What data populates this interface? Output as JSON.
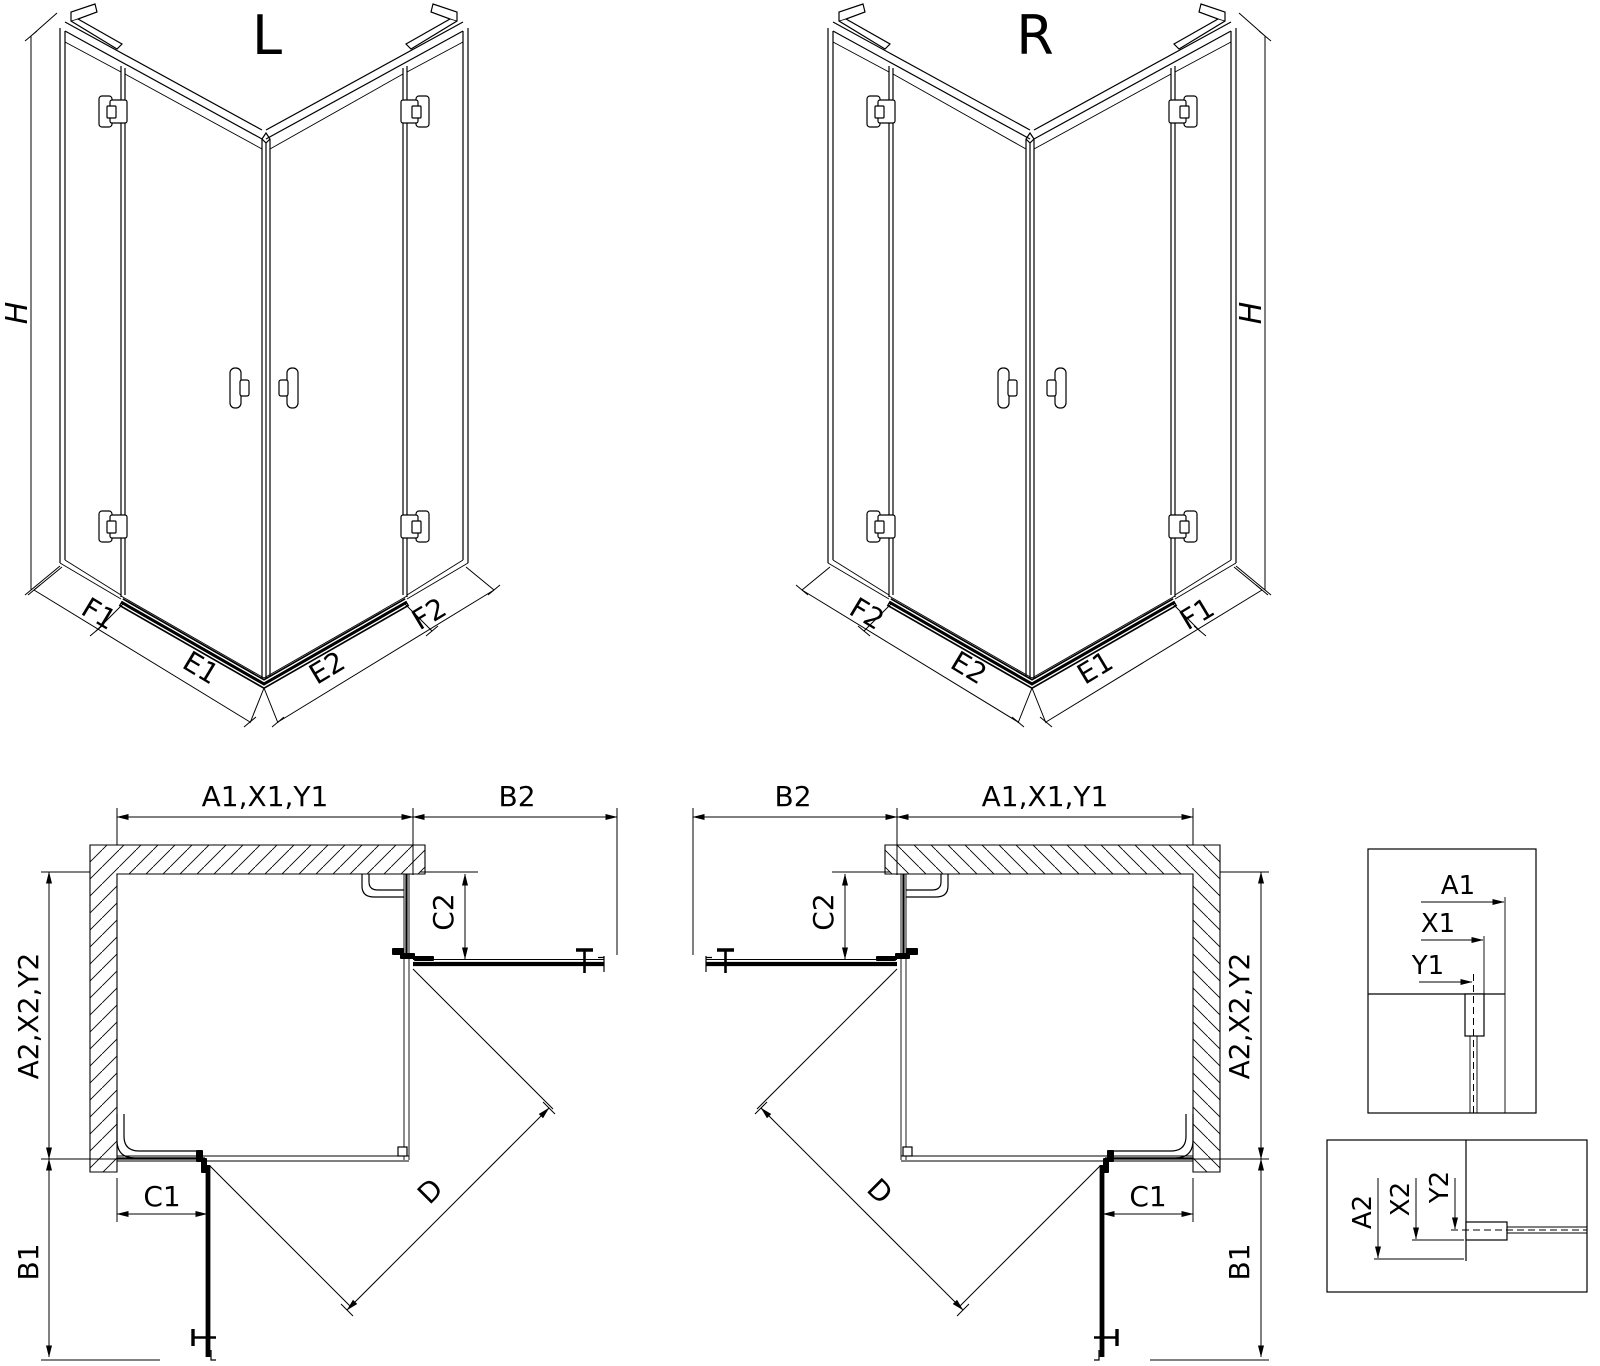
{
  "drawing": {
    "background": "#ffffff",
    "line_color": "#000000",
    "views": {
      "iso_left": {
        "title": "L",
        "height_label": "H",
        "segments": {
          "f1": "F1",
          "e1": "E1",
          "e2": "E2",
          "f2": "F2"
        }
      },
      "iso_right": {
        "title": "R",
        "height_label": "H",
        "segments": {
          "f1": "F1",
          "e1": "E1",
          "e2": "E2",
          "f2": "F2"
        }
      },
      "plan_left": {
        "top_width": "A1,X1,Y1",
        "door_top": "B2",
        "fixed_top": "C2",
        "side_depth": "A2,X2,Y2",
        "fixed_side": "C1",
        "door_side": "B1",
        "diagonal": "D"
      },
      "plan_right": {
        "top_width": "A1,X1,Y1",
        "door_top": "B2",
        "fixed_top": "C2",
        "side_depth": "A2,X2,Y2",
        "fixed_side": "C1",
        "door_side": "B1",
        "diagonal": "D"
      },
      "detail_top": {
        "a1": "A1",
        "x1": "X1",
        "y1": "Y1"
      },
      "detail_bottom": {
        "a2": "A2",
        "x2": "X2",
        "y2": "Y2"
      }
    }
  }
}
